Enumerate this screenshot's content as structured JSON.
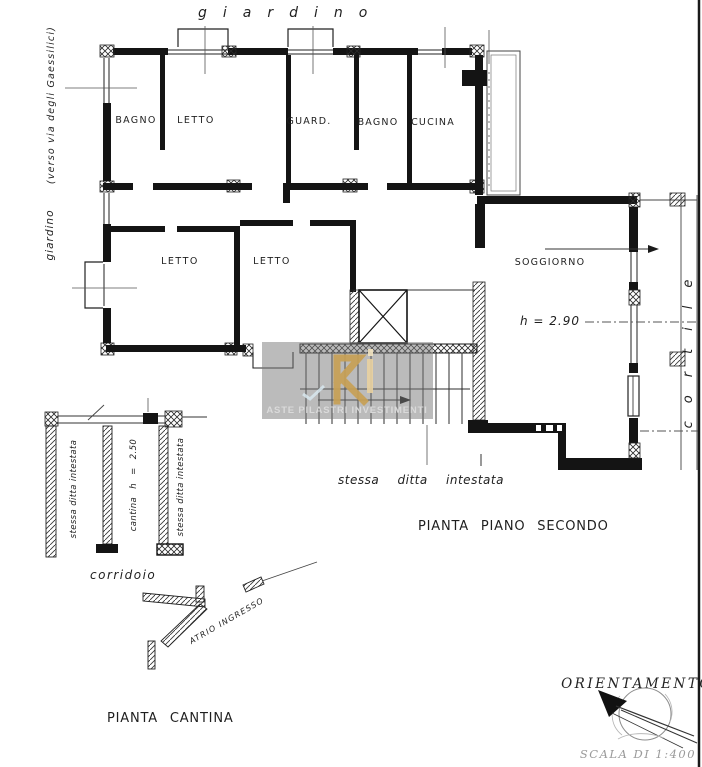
{
  "second_floor": {
    "caption": "PIANTA PIANO SECONDO",
    "note": "stessa  ditta  intestata",
    "rooms": {
      "bagno1": "BAGNO",
      "letto1": "LETTO",
      "guard": "GUARD.",
      "bagno2": "BAGNO",
      "cucina": "CUCINA",
      "letto2": "LETTO",
      "letto3": "LETTO",
      "soggiorno": "SOGGIORNO",
      "soggiorno_height": "h = 2.90"
    },
    "context": {
      "garden_top": "giardino",
      "garden_left": "giardino",
      "street_left": "(verso via degli Gaessilici)",
      "courtyard_right": "cortile"
    }
  },
  "cantina": {
    "caption": "PIANTA CANTINA",
    "cell_left": "stessa ditta intestata",
    "cell_middle": "cantina   h = 2.50",
    "cell_right": "stessa ditta intestata",
    "corridor": "corridoio",
    "atrium": "ATRIO  INGRESSO"
  },
  "orientation": {
    "title": "ORIENTAMENTO",
    "scale": "SCALA DI 1:400"
  },
  "watermark": {
    "text": "ASTE PILASTRI INVESTIMENTI",
    "logo_color": "#c79f55",
    "box_color": "#777777"
  },
  "colors": {
    "ink": "#1a1a1a",
    "faint": "#9a9a9a"
  }
}
